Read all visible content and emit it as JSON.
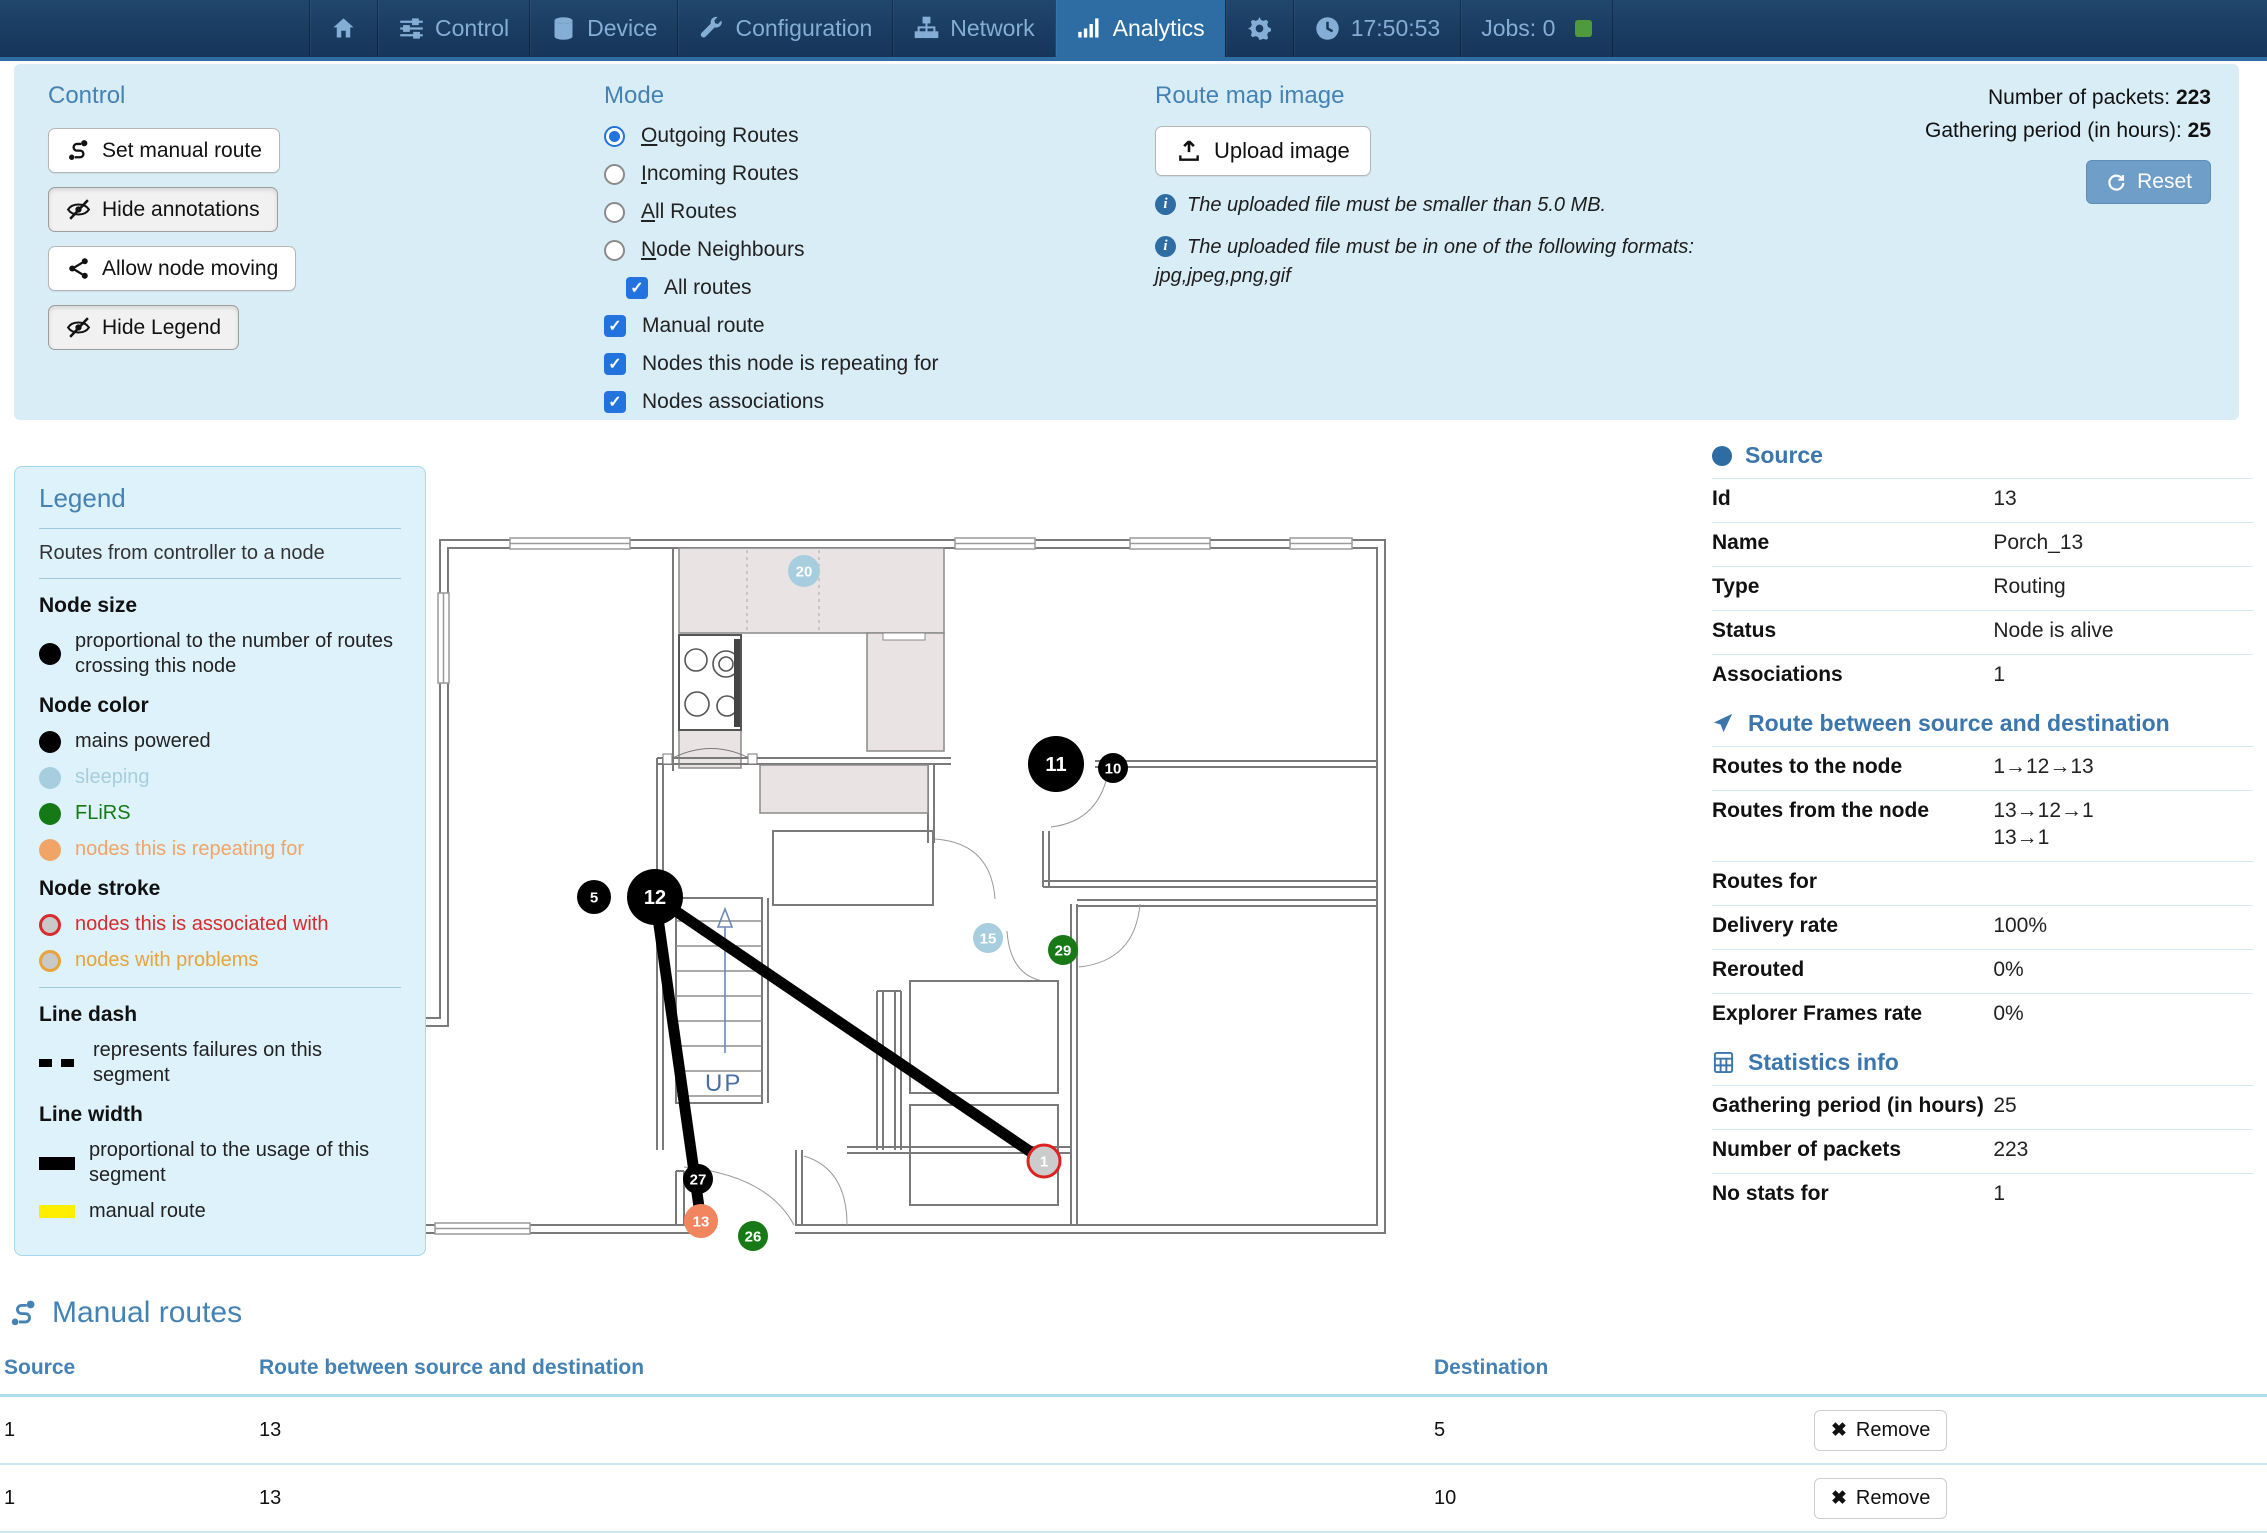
{
  "nav": {
    "tabs": [
      {
        "icon": "home",
        "label": ""
      },
      {
        "icon": "sliders",
        "label": "Control"
      },
      {
        "icon": "database",
        "label": "Device"
      },
      {
        "icon": "wrench",
        "label": "Configuration"
      },
      {
        "icon": "sitemap",
        "label": "Network"
      },
      {
        "icon": "chart",
        "label": "Analytics",
        "active": true
      },
      {
        "icon": "gear",
        "label": ""
      }
    ],
    "time": "17:50:53",
    "jobs_label": "Jobs: 0"
  },
  "panel": {
    "control": {
      "title": "Control",
      "buttons": [
        {
          "label": "Set manual route",
          "icon": "route"
        },
        {
          "label": "Hide annotations",
          "icon": "eye-slash"
        },
        {
          "label": "Allow node moving",
          "icon": "share"
        },
        {
          "label": "Hide Legend",
          "icon": "eye-slash"
        }
      ]
    },
    "mode": {
      "title": "Mode",
      "radios": [
        {
          "label": "Outgoing Routes",
          "selected": true
        },
        {
          "label": "Incoming Routes",
          "selected": false
        },
        {
          "label": "All Routes",
          "selected": false
        },
        {
          "label": "Node Neighbours",
          "selected": false
        }
      ],
      "checkboxes": [
        {
          "label": "All routes",
          "checked": true,
          "indent": true
        },
        {
          "label": "Manual route",
          "checked": true,
          "indent": false
        },
        {
          "label": "Nodes this node is repeating for",
          "checked": true,
          "indent": false
        },
        {
          "label": "Nodes associations",
          "checked": true,
          "indent": false
        }
      ]
    },
    "upload": {
      "title": "Route map image",
      "button_label": "Upload image",
      "note1": "The uploaded file must be smaller than 5.0 MB.",
      "note2": "The uploaded file must be in one of the following formats:",
      "formats_line": "jpg,jpeg,png,gif"
    },
    "stats": {
      "packets_label": "Number of packets:",
      "packets_value": "223",
      "period_label": "Gathering period (in hours):",
      "period_value": "25",
      "reset_label": "Reset"
    }
  },
  "legend": {
    "title": "Legend",
    "subtitle": "Routes from controller to a node",
    "sections": [
      {
        "heading": "Node size",
        "items": [
          {
            "swatch": "dot",
            "color": "#000000",
            "text": "proportional to the number of routes crossing this node",
            "text_color": "#222222"
          }
        ]
      },
      {
        "heading": "Node color",
        "items": [
          {
            "swatch": "dot",
            "color": "#000000",
            "text": "mains powered",
            "text_color": "#222222"
          },
          {
            "swatch": "dot",
            "color": "#a6cede",
            "text": "sleeping",
            "text_color": "#a6cede"
          },
          {
            "swatch": "dot",
            "color": "#157a15",
            "text": "FLiRS",
            "text_color": "#157a15"
          },
          {
            "swatch": "dot",
            "color": "#f0a468",
            "text": "nodes this is repeating for",
            "text_color": "#f0a468"
          }
        ]
      },
      {
        "heading": "Node stroke",
        "items": [
          {
            "swatch": "ring",
            "color": "#d92b2b",
            "text": "nodes this is associated with",
            "text_color": "#d92b2b"
          },
          {
            "swatch": "ring",
            "color": "#e8a33c",
            "text": "nodes with problems",
            "text_color": "#e8a33c"
          }
        ]
      },
      {
        "heading": "Line dash",
        "divider_before": true,
        "items": [
          {
            "swatch": "dash",
            "color": "#000000",
            "text": "represents failures on this segment",
            "text_color": "#222222"
          }
        ]
      },
      {
        "heading": "Line width",
        "items": [
          {
            "swatch": "thick",
            "color": "#000000",
            "text": "proportional to the usage of this segment",
            "text_color": "#222222"
          },
          {
            "swatch": "thick",
            "color": "#ffee00",
            "text": "manual route",
            "text_color": "#222222"
          }
        ]
      }
    ]
  },
  "map": {
    "up_label": "UP",
    "node_styles": {
      "mains": {
        "fill": "#000000",
        "text": "#ffffff"
      },
      "sleeping": {
        "fill": "#a6cede",
        "text": "#ffffff"
      },
      "flirs": {
        "fill": "#177a17",
        "text": "#ffffff"
      },
      "repeating": {
        "fill": "#f2855d",
        "text": "#ffffff"
      },
      "associated": {
        "fill": "#cccccc",
        "text": "#ffffff",
        "stroke": "#dd2222"
      }
    },
    "nodes": [
      {
        "id": "20",
        "x": 409,
        "y": 58,
        "r": 16,
        "type": "sleeping"
      },
      {
        "id": "11",
        "x": 661,
        "y": 251,
        "r": 28,
        "type": "mains"
      },
      {
        "id": "10",
        "x": 718,
        "y": 255,
        "r": 15,
        "type": "mains"
      },
      {
        "id": "5",
        "x": 199,
        "y": 384,
        "r": 17,
        "type": "mains"
      },
      {
        "id": "12",
        "x": 260,
        "y": 384,
        "r": 28,
        "type": "mains"
      },
      {
        "id": "15",
        "x": 593,
        "y": 425,
        "r": 15,
        "type": "sleeping"
      },
      {
        "id": "29",
        "x": 668,
        "y": 437,
        "r": 15,
        "type": "flirs"
      },
      {
        "id": "27",
        "x": 303,
        "y": 666,
        "r": 15,
        "type": "mains"
      },
      {
        "id": "13",
        "x": 306,
        "y": 708,
        "r": 17,
        "type": "repeating"
      },
      {
        "id": "26",
        "x": 358,
        "y": 723,
        "r": 15,
        "type": "flirs"
      },
      {
        "id": "1",
        "x": 649,
        "y": 648,
        "r": 16,
        "type": "associated"
      }
    ],
    "routes": [
      {
        "from": "12",
        "to": "1"
      },
      {
        "from": "12",
        "to": "13"
      }
    ],
    "route_color": "#000000",
    "route_width": 11
  },
  "source_panel": {
    "sections": [
      {
        "icon": "dot",
        "title": "Source",
        "rows": [
          {
            "label": "Id",
            "values": [
              "13"
            ]
          },
          {
            "label": "Name",
            "values": [
              "Porch_13"
            ]
          },
          {
            "label": "Type",
            "values": [
              "Routing"
            ]
          },
          {
            "label": "Status",
            "values": [
              "Node is alive"
            ]
          },
          {
            "label": "Associations",
            "values": [
              "1"
            ]
          }
        ]
      },
      {
        "icon": "arrow",
        "title": "Route between source and destination",
        "rows": [
          {
            "label": "Routes to the node",
            "values": [
              "1→12→13"
            ]
          },
          {
            "label": "Routes from the node",
            "values": [
              "13→12→1",
              "13→1"
            ]
          },
          {
            "label": "Routes for",
            "values": [
              ""
            ]
          },
          {
            "label": "Delivery rate",
            "values": [
              "100%"
            ]
          },
          {
            "label": "Rerouted",
            "values": [
              "0%"
            ]
          },
          {
            "label": "Explorer Frames rate",
            "values": [
              "0%"
            ]
          }
        ]
      },
      {
        "icon": "calc",
        "title": "Statistics info",
        "rows": [
          {
            "label": "Gathering period (in hours)",
            "values": [
              "25"
            ]
          },
          {
            "label": "Number of packets",
            "values": [
              "223"
            ]
          },
          {
            "label": "No stats for",
            "values": [
              "1"
            ]
          }
        ]
      }
    ]
  },
  "manual_routes": {
    "title": "Manual routes",
    "columns": [
      "Source",
      "Route between source and destination",
      "Destination"
    ],
    "remove_label": "Remove",
    "rows": [
      {
        "source": "1",
        "route": "13",
        "destination": "5"
      },
      {
        "source": "1",
        "route": "13",
        "destination": "10"
      }
    ]
  },
  "colors": {
    "nav_bg": "#1a3c61",
    "nav_active": "#2e6da4",
    "nav_text": "#84aed6",
    "panel_bg": "#d9edf7",
    "heading_blue": "#4582b4",
    "checkbox_blue": "#2273dd",
    "reset_btn": "#6f9fc9",
    "jobs_green": "#4e9a3c"
  }
}
